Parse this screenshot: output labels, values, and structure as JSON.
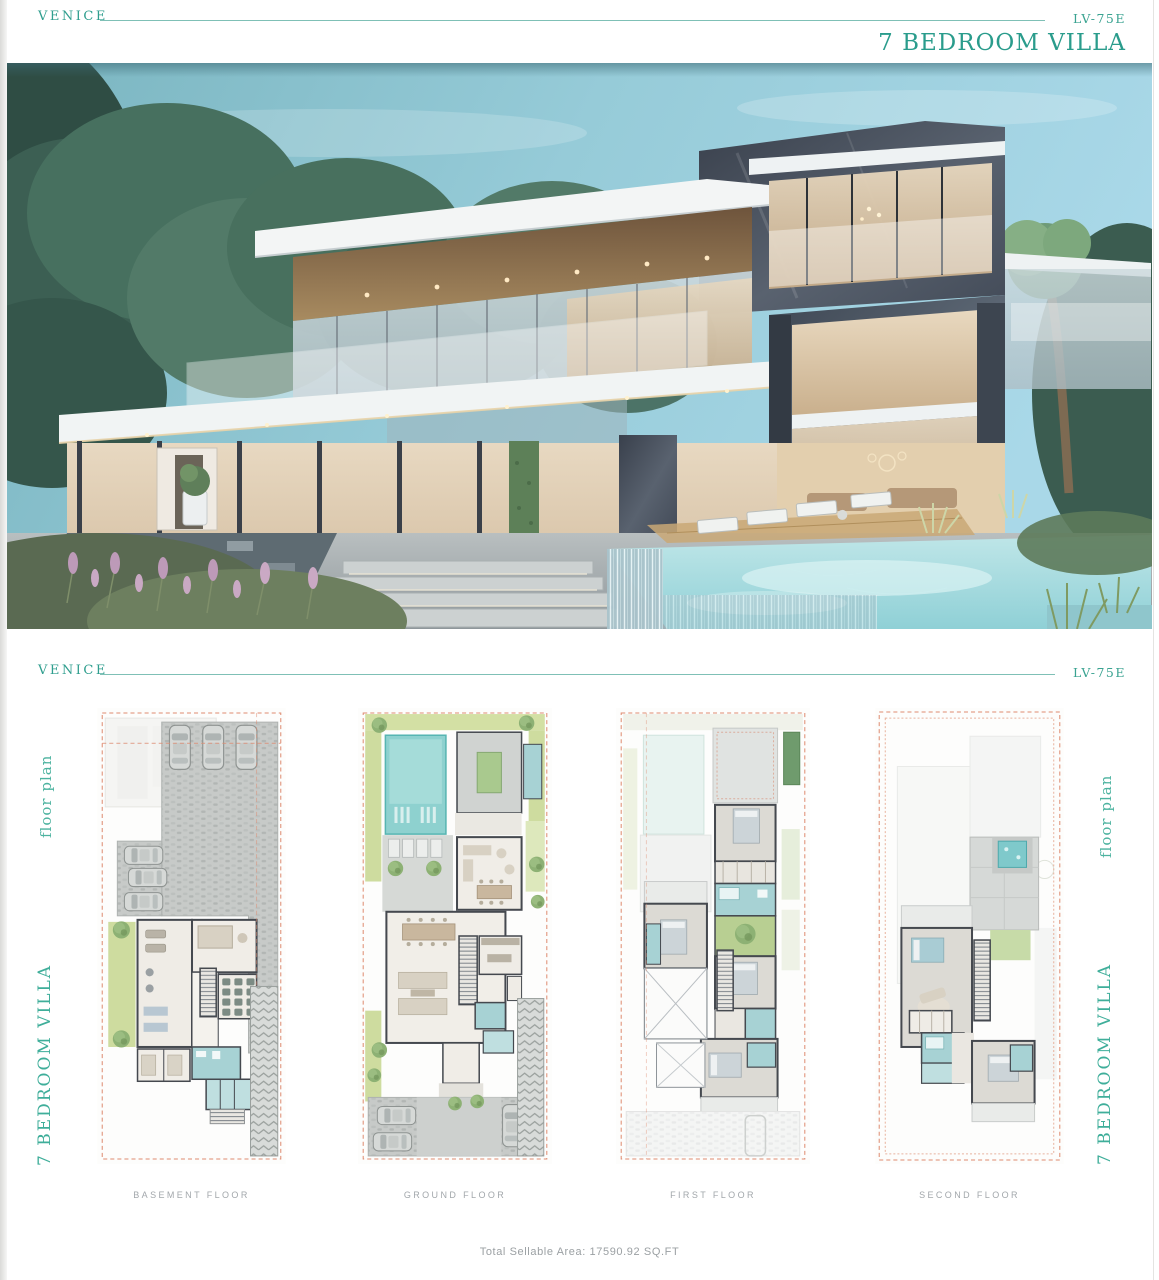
{
  "colors": {
    "brand_teal": "#2f9e8e",
    "line_teal": "#7fc0b6",
    "label_gray": "#a2a7ab",
    "plan_boundary_dash": "#de8b70",
    "bathroom_teal": "#a7d2d4",
    "pool_teal": "#8ed1cf",
    "lawn_green": "#cedc9f"
  },
  "header_top": {
    "project": "VENICE",
    "unit_code": "LV-75E",
    "title": "7 BEDROOM VILLA"
  },
  "header_section": {
    "project": "VENICE",
    "unit_code": "LV-75E"
  },
  "side_labels": {
    "left_top": "floor plan",
    "left_bottom": "7 BEDROOM VILLA",
    "right_top": "floor plan",
    "right_bottom": "7 BEDROOM VILLA"
  },
  "floor_plans": [
    {
      "label": "BASEMENT FLOOR"
    },
    {
      "label": "GROUND FLOOR"
    },
    {
      "label": "FIRST FLOOR"
    },
    {
      "label": "SECOND FLOOR"
    }
  ],
  "footer": {
    "total_sellable_area": "Total Sellable Area: 17590.92 SQ.FT"
  },
  "hero": {
    "name": "villa-exterior-render"
  }
}
